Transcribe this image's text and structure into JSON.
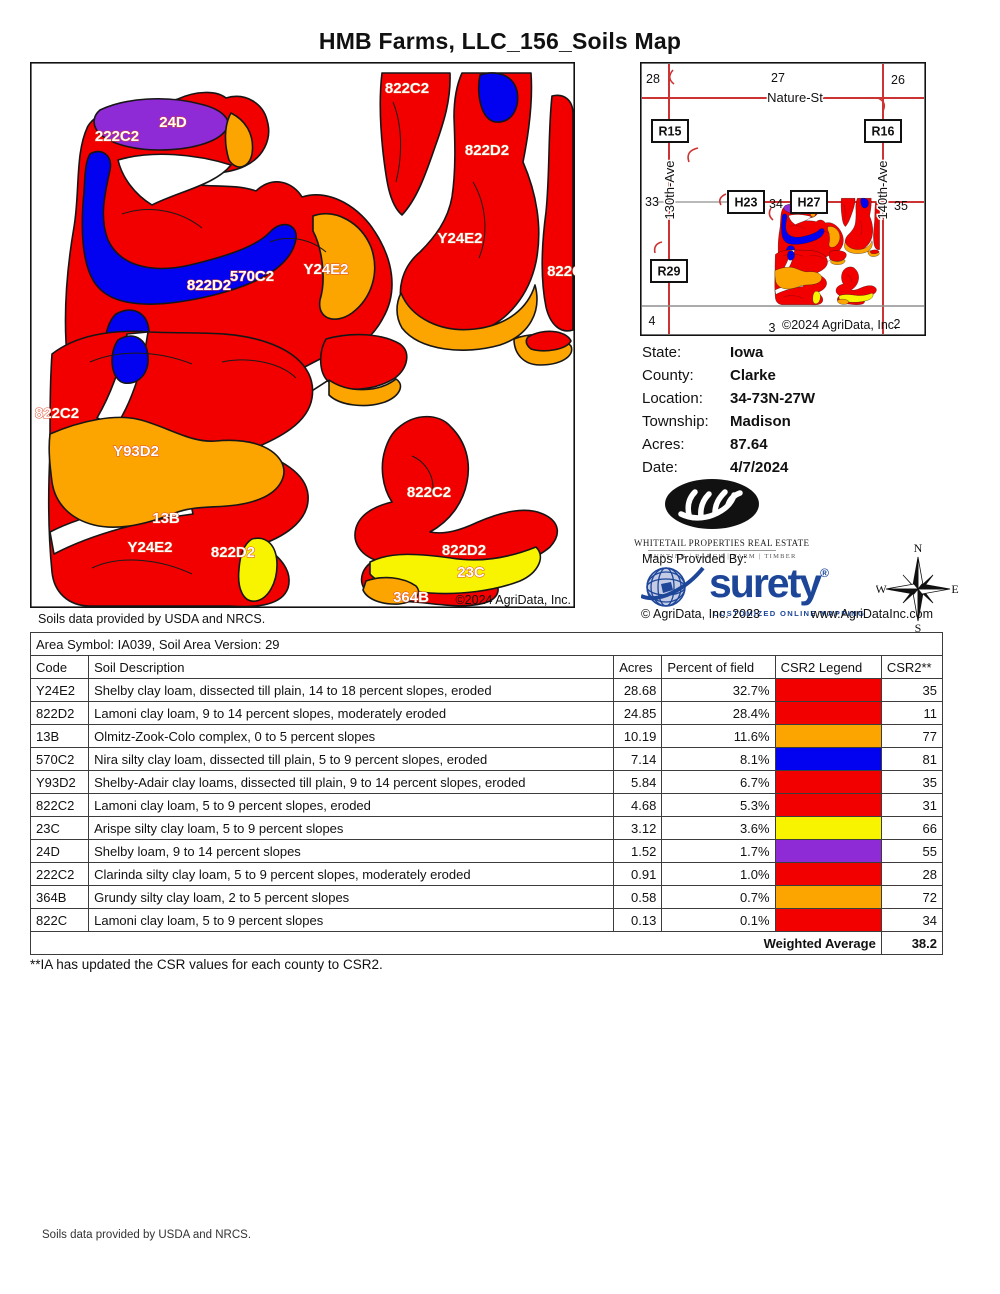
{
  "title": "HMB Farms, LLC_156_Soils Map",
  "colors": {
    "soil_red": "#f20000",
    "soil_orange": "#fca400",
    "soil_blue": "#0202f0",
    "soil_yellow": "#f8f400",
    "soil_purple": "#8e2bd6",
    "label_halo": "#e04828",
    "road_red": "#cc3333",
    "road_gray": "#8f8f8f",
    "surety_blue": "#1d4699"
  },
  "main_map": {
    "caption": "Soils data provided by USDA and NRCS.",
    "copyright": "©2024 AgriData, Inc.",
    "labels": [
      {
        "t": "822C2",
        "x": 377,
        "y": 31
      },
      {
        "t": "24D",
        "x": 143,
        "y": 65
      },
      {
        "t": "222C2",
        "x": 87,
        "y": 79
      },
      {
        "t": "822D2",
        "x": 457,
        "y": 93
      },
      {
        "t": "Y24E2",
        "x": 430,
        "y": 181
      },
      {
        "t": "Y24E2",
        "x": 296,
        "y": 212
      },
      {
        "t": "570C2",
        "x": 222,
        "y": 219
      },
      {
        "t": "822D2",
        "x": 179,
        "y": 228
      },
      {
        "t": "822C",
        "x": 535,
        "y": 214
      },
      {
        "t": "822C2",
        "x": 27,
        "y": 356
      },
      {
        "t": "Y93D2",
        "x": 106,
        "y": 394
      },
      {
        "t": "13B",
        "x": 136,
        "y": 461
      },
      {
        "t": "Y24E2",
        "x": 120,
        "y": 490
      },
      {
        "t": "822D2",
        "x": 203,
        "y": 495
      },
      {
        "t": "822C2",
        "x": 399,
        "y": 435
      },
      {
        "t": "822D2",
        "x": 434,
        "y": 493
      },
      {
        "t": "23C",
        "x": 441,
        "y": 515
      },
      {
        "t": "364B",
        "x": 381,
        "y": 540
      }
    ]
  },
  "locator": {
    "copyright": "©2024 AgriData, Inc.",
    "roads": {
      "nature": "Nature-St",
      "ave130": "130th-Ave",
      "ave140": "140th-Ave"
    },
    "sections": [
      {
        "t": "28",
        "x": 13,
        "y": 21
      },
      {
        "t": "27",
        "x": 138,
        "y": 20
      },
      {
        "t": "26",
        "x": 258,
        "y": 22
      },
      {
        "t": "33",
        "x": 12,
        "y": 144
      },
      {
        "t": "34",
        "x": 136,
        "y": 146
      },
      {
        "t": "35",
        "x": 261,
        "y": 148
      },
      {
        "t": "4",
        "x": 12,
        "y": 263
      },
      {
        "t": "3",
        "x": 132,
        "y": 270
      },
      {
        "t": "2",
        "x": 257,
        "y": 266
      }
    ],
    "markers": [
      {
        "t": "R15",
        "x": 30,
        "y": 69
      },
      {
        "t": "R16",
        "x": 243,
        "y": 69
      },
      {
        "t": "H23",
        "x": 106,
        "y": 140
      },
      {
        "t": "H27",
        "x": 169,
        "y": 140
      },
      {
        "t": "R29",
        "x": 29,
        "y": 209
      }
    ]
  },
  "info": {
    "rows": [
      {
        "key": "state",
        "label": "State:",
        "value": "Iowa"
      },
      {
        "key": "county",
        "label": "County:",
        "value": "Clarke"
      },
      {
        "key": "location",
        "label": "Location:",
        "value": "34-73N-27W"
      },
      {
        "key": "township",
        "label": "Township:",
        "value": "Madison"
      },
      {
        "key": "acres",
        "label": "Acres:",
        "value": "87.64"
      },
      {
        "key": "date",
        "label": "Date:",
        "value": "4/7/2024"
      }
    ]
  },
  "branding": {
    "whitetail_name": "WHITETAIL PROPERTIES REAL ESTATE",
    "whitetail_tagline": "HUNTING  |  RANCH  |  FARM  |  TIMBER",
    "maps_provided_by": "Maps Provided By:",
    "surety_name": "surety",
    "surety_reg": "®",
    "surety_tagline": "CUSTOMIZED ONLINE MAPPING",
    "agridata_copyright": "© AgriData, Inc. 2023",
    "agridata_website": "www.AgriDataInc.com"
  },
  "compass": {
    "n": "N",
    "e": "E",
    "s": "S",
    "w": "W"
  },
  "table": {
    "area_title": "Area Symbol: IA039, Soil Area Version: 29",
    "headers": [
      "Code",
      "Soil Description",
      "Acres",
      "Percent of field",
      "CSR2 Legend",
      "CSR2**"
    ],
    "rows": [
      {
        "code": "Y24E2",
        "description": "Shelby clay loam, dissected till plain, 14 to 18 percent slopes, eroded",
        "acres": "28.68",
        "percent": "32.7%",
        "color": "soil_red",
        "csr2": "35"
      },
      {
        "code": "822D2",
        "description": "Lamoni clay loam, 9 to 14 percent slopes, moderately eroded",
        "acres": "24.85",
        "percent": "28.4%",
        "color": "soil_red",
        "csr2": "11"
      },
      {
        "code": "13B",
        "description": "Olmitz-Zook-Colo complex, 0 to 5 percent slopes",
        "acres": "10.19",
        "percent": "11.6%",
        "color": "soil_orange",
        "csr2": "77"
      },
      {
        "code": "570C2",
        "description": "Nira silty clay loam, dissected till plain, 5 to 9 percent slopes, eroded",
        "acres": "7.14",
        "percent": "8.1%",
        "color": "soil_blue",
        "csr2": "81"
      },
      {
        "code": "Y93D2",
        "description": "Shelby-Adair clay loams, dissected till plain, 9 to 14 percent slopes, eroded",
        "acres": "5.84",
        "percent": "6.7%",
        "color": "soil_red",
        "csr2": "35"
      },
      {
        "code": "822C2",
        "description": "Lamoni clay loam, 5 to 9 percent slopes, eroded",
        "acres": "4.68",
        "percent": "5.3%",
        "color": "soil_red",
        "csr2": "31"
      },
      {
        "code": "23C",
        "description": "Arispe silty clay loam, 5 to 9 percent slopes",
        "acres": "3.12",
        "percent": "3.6%",
        "color": "soil_yellow",
        "csr2": "66"
      },
      {
        "code": "24D",
        "description": "Shelby loam, 9 to 14 percent slopes",
        "acres": "1.52",
        "percent": "1.7%",
        "color": "soil_purple",
        "csr2": "55"
      },
      {
        "code": "222C2",
        "description": "Clarinda silty clay loam, 5 to 9 percent slopes, moderately eroded",
        "acres": "0.91",
        "percent": "1.0%",
        "color": "soil_red",
        "csr2": "28"
      },
      {
        "code": "364B",
        "description": "Grundy silty clay loam, 2 to 5 percent slopes",
        "acres": "0.58",
        "percent": "0.7%",
        "color": "soil_orange",
        "csr2": "72"
      },
      {
        "code": "822C",
        "description": "Lamoni clay loam, 5 to 9 percent slopes",
        "acres": "0.13",
        "percent": "0.1%",
        "color": "soil_red",
        "csr2": "34"
      }
    ],
    "weighted_average_label": "Weighted Average",
    "weighted_average_value": "38.2"
  },
  "footnote": "**IA has updated the CSR values for each county to CSR2.",
  "page_footer": "Soils data provided by USDA and NRCS."
}
